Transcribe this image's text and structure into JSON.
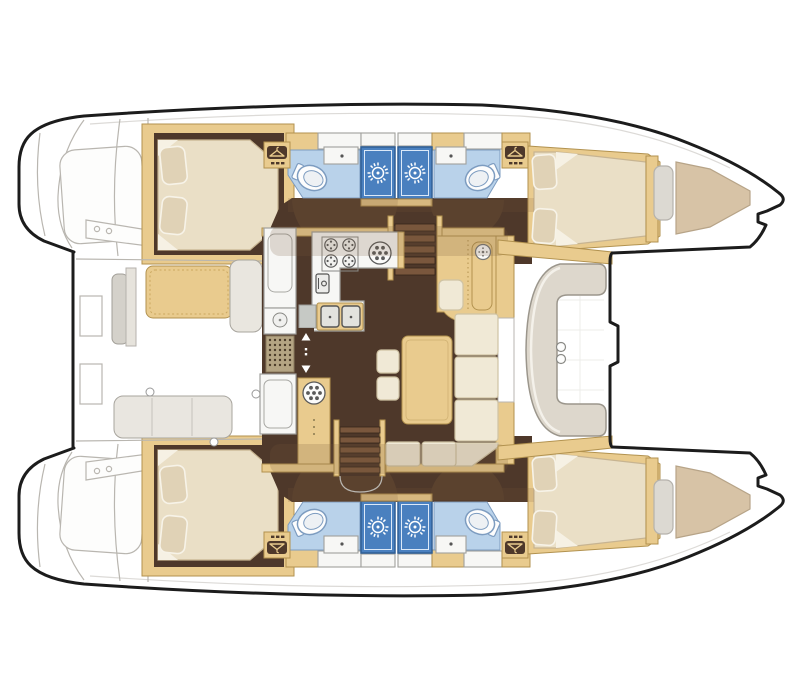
{
  "diagram": {
    "kind": "catamaran-floor-plan",
    "view": "top-down",
    "bow_direction": "right",
    "stern_direction": "left",
    "hulls": [
      "port-hull",
      "starboard-hull"
    ],
    "cabin_count": 4,
    "head_count": 4,
    "shower_count": 4,
    "berths": {
      "double_beds": 4,
      "forepeak_berths": 2,
      "pillows_per_double_bed": 2
    },
    "center_deck": {
      "aft_cockpit": [
        "cockpit-table",
        "side-bench",
        "aft-bench",
        "transom-steps",
        "davit-beam"
      ],
      "saloon": [
        "galley",
        "nav-station",
        "l-sofa",
        "saloon-table",
        "stools",
        "companionway-stairs-port",
        "companionway-stairs-starboard",
        "sliding-door"
      ],
      "fwd_cockpit": [
        "c-bench",
        "cup-holders",
        "mast-step-notch"
      ],
      "bow_deck": [
        "trampoline-area"
      ]
    },
    "galley": {
      "stove_burners": 4,
      "round_sink": 1,
      "double_sink_basins": 2,
      "fridge": 1,
      "drainboard": 1
    },
    "per_hull_rooms": [
      "aft-cabin",
      "aft-head",
      "shower-aft",
      "shower-fwd",
      "fwd-head",
      "fwd-cabin",
      "forepeak-berth"
    ],
    "fixtures_per_head": [
      "toilet",
      "wash-basin"
    ],
    "wardrobe_lockers_per_hull": 2,
    "stools": 2,
    "cup_holders": 2
  },
  "icons": [
    "sun-shower-icon",
    "coat-hanger-icon",
    "stove-burner-icon",
    "round-sink-icon",
    "toilet-icon",
    "double-sink-icon",
    "door-arrow-up-icon",
    "door-arrow-down-icon",
    "instrument-dial-icon",
    "fridge-icon",
    "vent-grate-icon"
  ],
  "palette": {
    "background": "#ffffff",
    "hullWhite": "#ffffff",
    "outline": "#1c1c1c",
    "sketch": "#b9b6b0",
    "wood": "#e9cb8e",
    "woodDark": "#b2924f",
    "floor": "#4e382a",
    "shadow": "#7a5a3a",
    "cream": "#eadfc6",
    "creamLine": "#c7b491",
    "pillow": "#e0d2b6",
    "headFloor": "#b9d2ea",
    "headLine": "#7d9cc0",
    "shower": "#4a80bf",
    "counter": "#f7f7f5",
    "counterLine": "#a0a09c",
    "sofaCream": "#f0e9d6",
    "sofaLine": "#cfc3a4",
    "benchGray": "#ddd7cc",
    "benchLine": "#9b968c",
    "taupe": "#d7c3a6",
    "tread": "#7a573d",
    "grate": "#b4a483"
  }
}
